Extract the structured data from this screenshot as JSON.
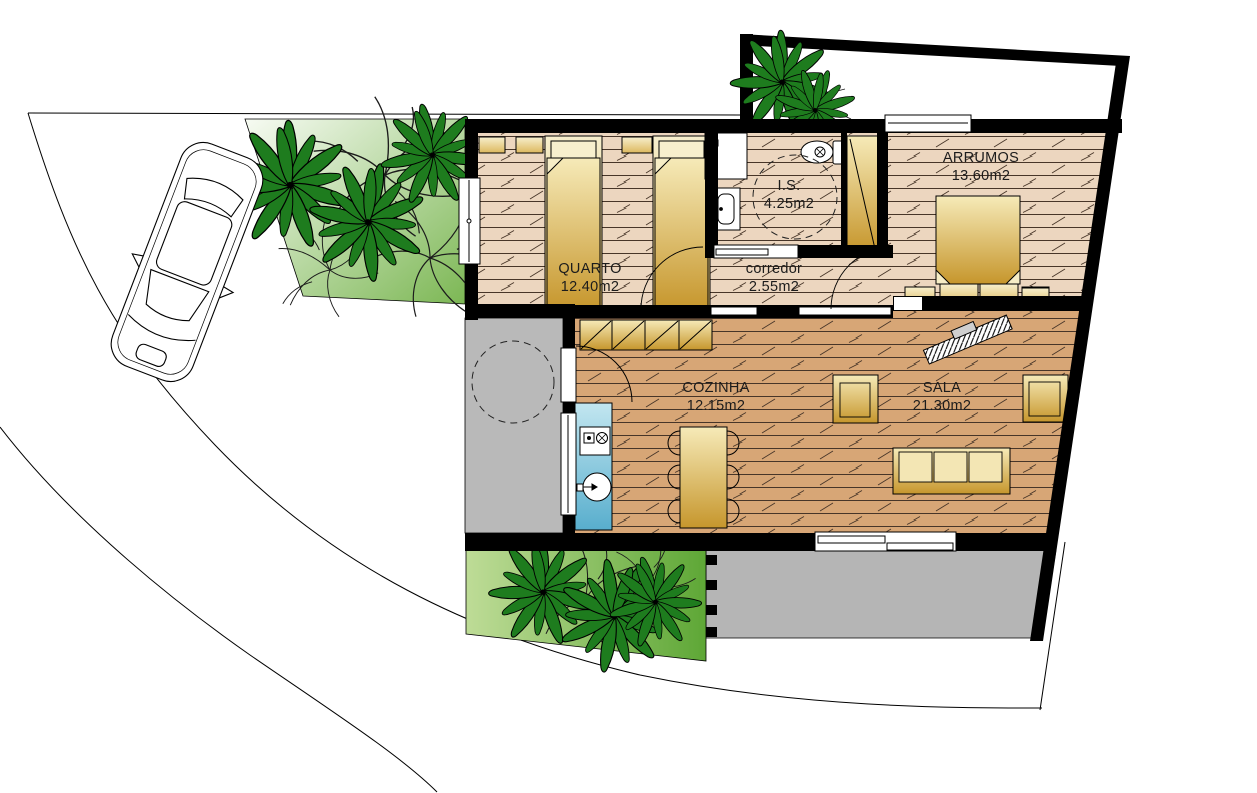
{
  "plan": {
    "type": "residential-floor-plan",
    "rooms": [
      {
        "id": "quarto",
        "label": "QUARTO",
        "area": "12.40m2"
      },
      {
        "id": "is",
        "label": "I.S.",
        "area": "4.25m2"
      },
      {
        "id": "corredor",
        "label": "corredor",
        "area": "2.55m2"
      },
      {
        "id": "arrumos",
        "label": "ARRUMOS",
        "area": "13.60m2"
      },
      {
        "id": "cozinha",
        "label": "COZINHA",
        "area": "12.15m2"
      },
      {
        "id": "sala",
        "label": "SALA",
        "area": "21.30m2"
      }
    ],
    "colors": {
      "wall": "#000000",
      "floor_bedrooms": "#ecd6bf",
      "floor_living": "#d7a676",
      "furniture_gold_light": "#f6eab8",
      "furniture_gold_dark": "#c6962c",
      "counter_blue_light": "#c2e6f0",
      "counter_blue_dark": "#58aecd",
      "patio_gray": "#b9b9b9",
      "grass_light": "#f2f8ec",
      "grass_dark": "#77b44c",
      "palm_green": "#1e7c1e"
    }
  }
}
